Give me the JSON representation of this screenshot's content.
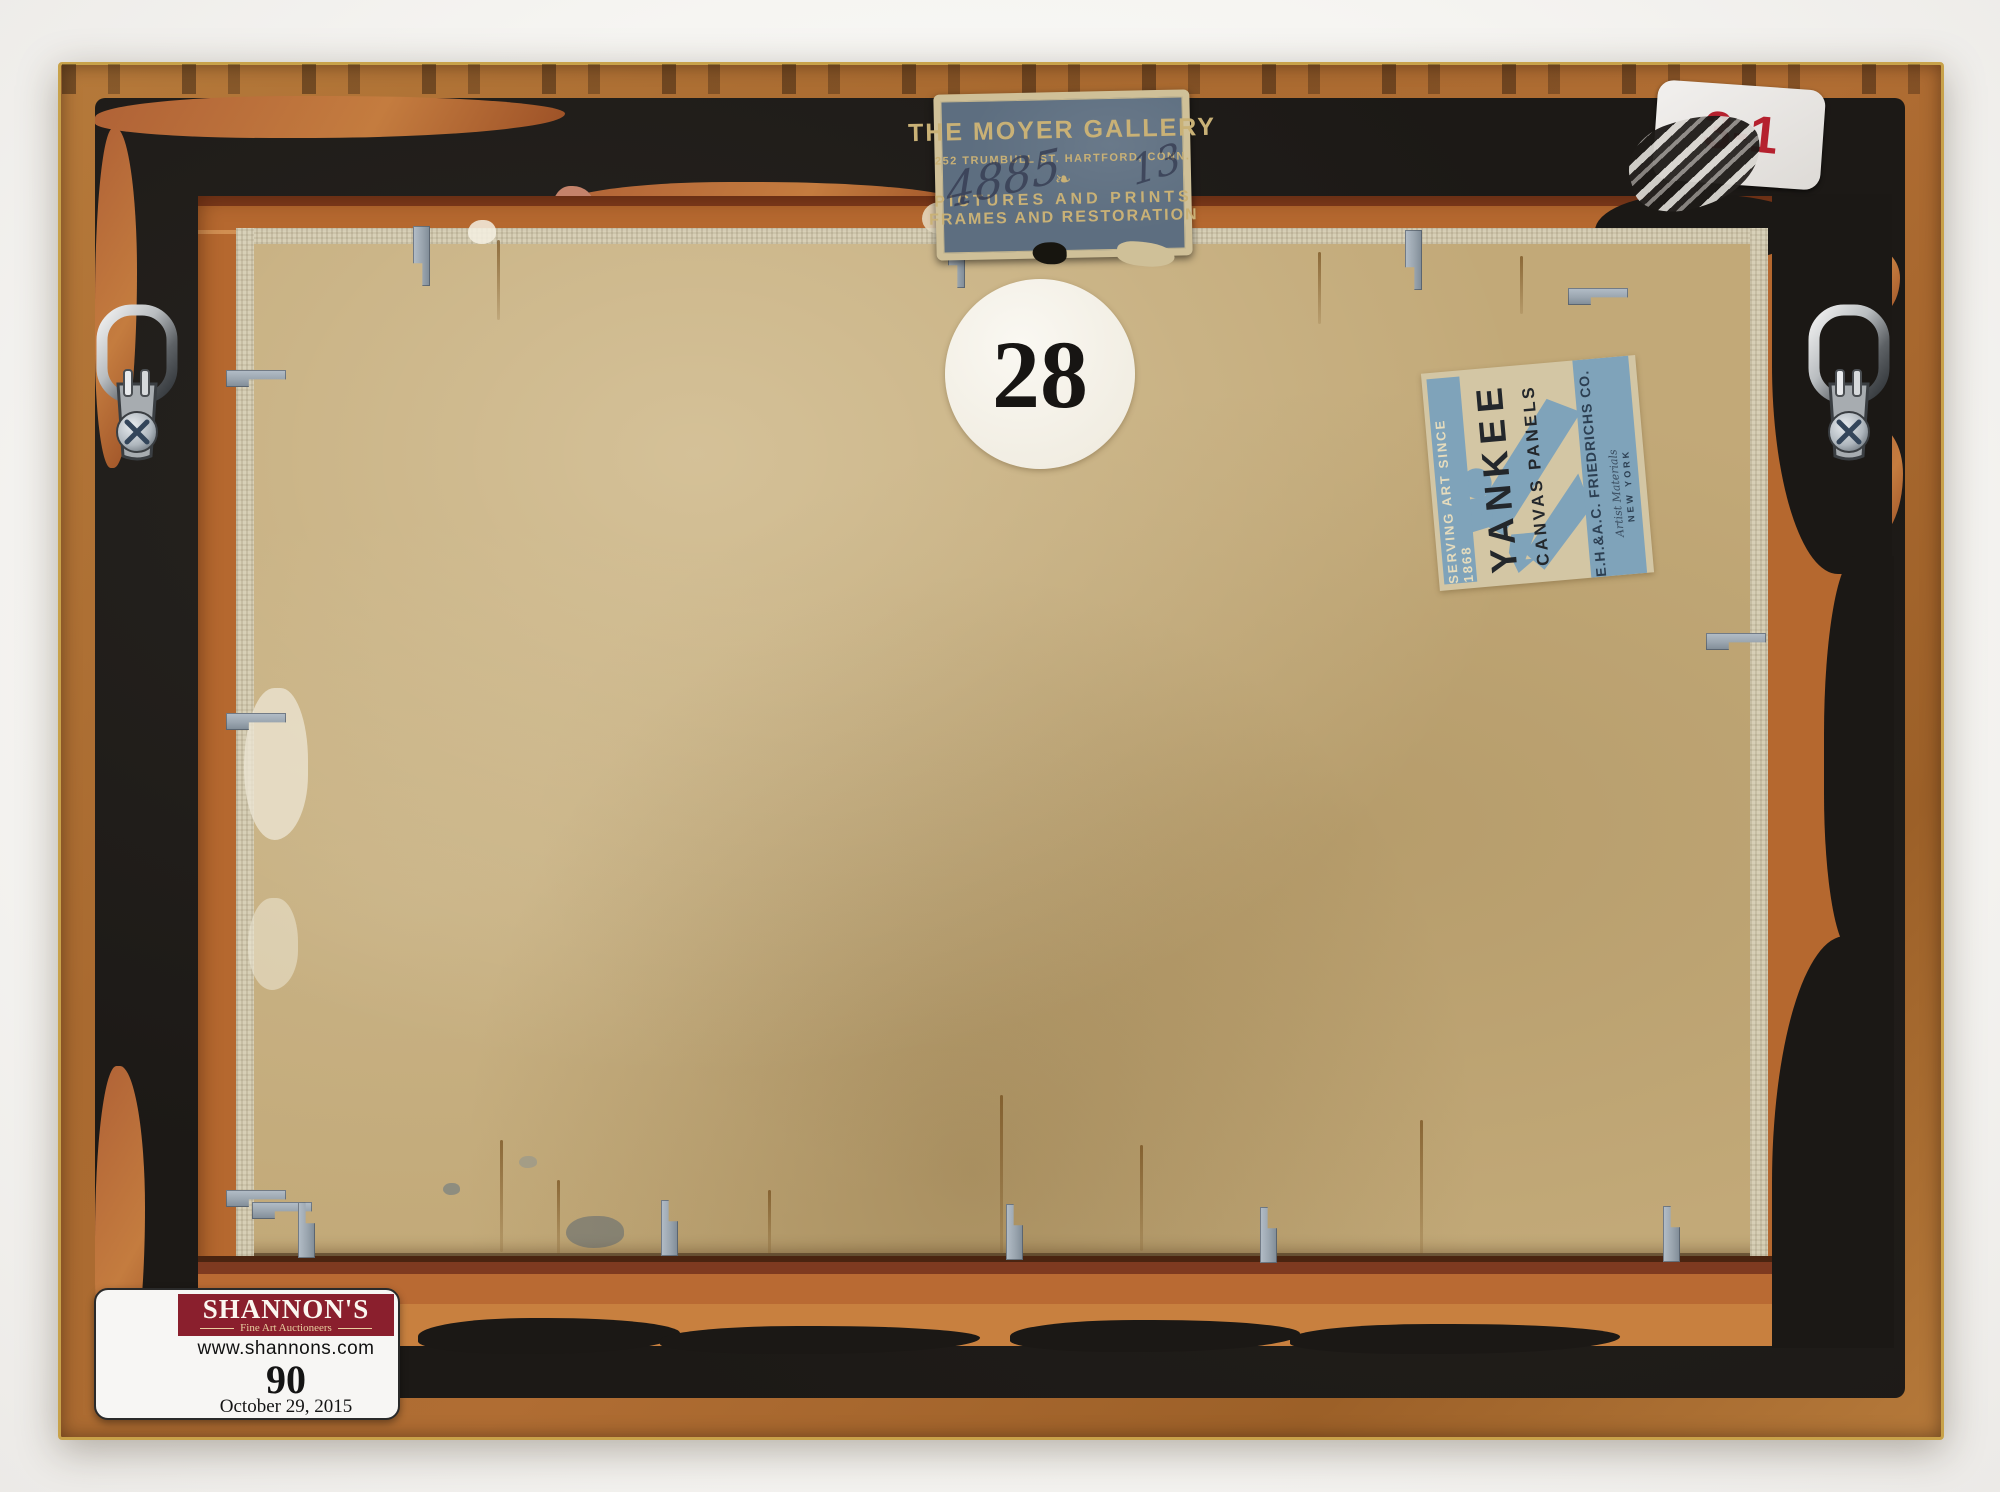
{
  "photo_subject": "verso of a framed canvas panel painting",
  "moyer_label": {
    "title": "THE MOYER GALLERY",
    "address": "252 TRUMBULL ST.  HARTFORD, CONN.",
    "ornament": "❧",
    "line3": "PICTURES AND PRINTS",
    "line4": "FRAMES AND RESTORATION",
    "handwriting_lot": "4885",
    "handwriting_suffix": "13"
  },
  "lot_circle": {
    "number": "28"
  },
  "yankee_label": {
    "serving": "SERVING ART SINCE 1868",
    "brand": "YANKEE",
    "product": "CANVAS PANELS",
    "company": "E.H.&A.C. FRIEDRICHS CO.",
    "materials": "Artist Materials",
    "city": "NEW YORK"
  },
  "corner_sticker": {
    "code": "3-1"
  },
  "auction_label": {
    "house": "SHANNON'S",
    "division": "Fine Art Auctioneers",
    "website": "www.shannons.com",
    "lot_number": "90",
    "sale_date": "October 29, 2015"
  },
  "colors": {
    "frame_wood": "#a96a30",
    "backing_paper": "#1c1916",
    "panel_tan": "#c2a978",
    "moyer_blue": "#5d6e80",
    "yankee_blue": "#7fa3ba",
    "auction_maroon": "#8a1f2d",
    "sticker_red": "#b5212e",
    "clip_gray": "#9aa5af"
  }
}
